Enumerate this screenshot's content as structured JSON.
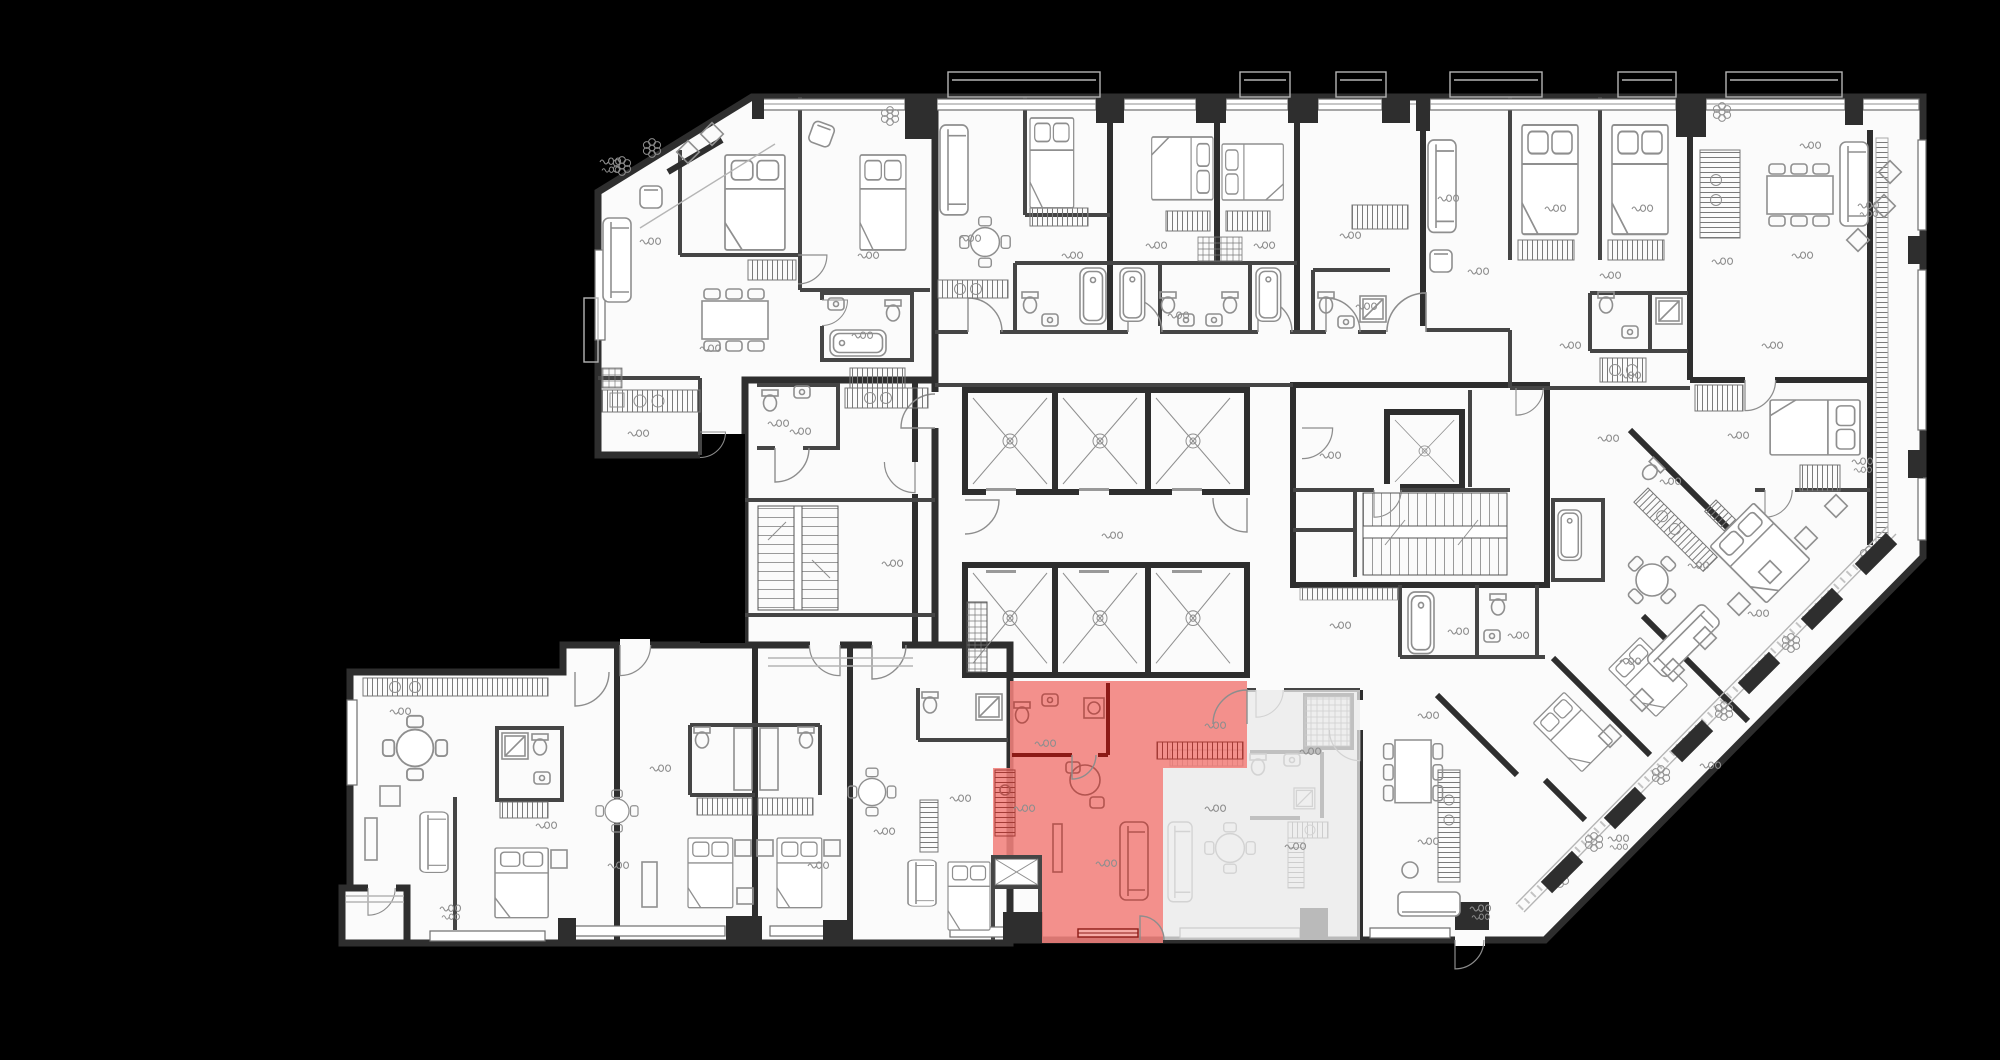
{
  "scene": {
    "background": "#000000",
    "floor": "#fbfbfb",
    "wall": "#2e2e2e",
    "partition": "#454545",
    "furniture": "#8f8f8f",
    "balcony_line": "#b5b5b5",
    "label_color": "#8e8e8e"
  },
  "selected_unit": {
    "name": "highlighted-apartment",
    "fill": "#f1817c",
    "border": "#9b1210",
    "inner_wall": "#8c1a16",
    "detail": "#b2544f",
    "window_fill": "#f6aaa5"
  },
  "secondary_unit": {
    "name": "adjacent-apartment-muted",
    "fill": "#e9e9e9"
  },
  "decor": {
    "room_labels": [
      [
        640,
        238
      ],
      [
        700,
        345
      ],
      [
        628,
        430
      ],
      [
        768,
        420
      ],
      [
        858,
        252
      ],
      [
        852,
        332
      ],
      [
        600,
        158,
        2
      ],
      [
        960,
        235
      ],
      [
        1062,
        252
      ],
      [
        1146,
        242
      ],
      [
        1254,
        242
      ],
      [
        1168,
        312
      ],
      [
        1340,
        232
      ],
      [
        1356,
        303
      ],
      [
        1438,
        195
      ],
      [
        1545,
        205
      ],
      [
        1632,
        205
      ],
      [
        1468,
        268
      ],
      [
        1600,
        272
      ],
      [
        1712,
        258
      ],
      [
        1800,
        142
      ],
      [
        1792,
        252
      ],
      [
        1858,
        202,
        2
      ],
      [
        1762,
        342
      ],
      [
        1560,
        342
      ],
      [
        1620,
        372
      ],
      [
        1598,
        435
      ],
      [
        1728,
        432
      ],
      [
        1660,
        478
      ],
      [
        1852,
        458,
        2
      ],
      [
        1688,
        562
      ],
      [
        1748,
        610
      ],
      [
        1620,
        658
      ],
      [
        1700,
        762
      ],
      [
        1608,
        835,
        2
      ],
      [
        790,
        428
      ],
      [
        882,
        560
      ],
      [
        1102,
        532
      ],
      [
        1320,
        452
      ],
      [
        1330,
        622
      ],
      [
        1448,
        628
      ],
      [
        1508,
        632
      ],
      [
        390,
        708
      ],
      [
        536,
        822
      ],
      [
        650,
        765
      ],
      [
        608,
        862
      ],
      [
        808,
        862
      ],
      [
        874,
        828
      ],
      [
        950,
        795
      ],
      [
        440,
        905,
        2
      ],
      [
        1300,
        748
      ],
      [
        1205,
        805
      ],
      [
        1285,
        843
      ],
      [
        1418,
        712
      ],
      [
        1418,
        838
      ],
      [
        1470,
        905,
        2
      ]
    ],
    "selected_labels": [
      [
        1035,
        740
      ],
      [
        1014,
        805
      ],
      [
        1096,
        860
      ],
      [
        1205,
        722
      ]
    ],
    "flowers": [
      [
        622,
        166
      ],
      [
        652,
        148
      ],
      [
        890,
        116
      ],
      [
        1722,
        112
      ],
      [
        1594,
        842
      ],
      [
        1661,
        775
      ],
      [
        1724,
        711
      ],
      [
        1791,
        643
      ],
      [
        1560,
        878
      ],
      [
        1869,
        556
      ]
    ],
    "top_balconies": [
      [
        948,
        152
      ],
      [
        1240,
        50
      ],
      [
        1336,
        50
      ],
      [
        1450,
        92
      ],
      [
        1618,
        58
      ],
      [
        1726,
        116
      ]
    ],
    "diag_piers": [
      [
        1562,
        872
      ],
      [
        1625,
        808
      ],
      [
        1692,
        741
      ],
      [
        1759,
        673
      ],
      [
        1822,
        609
      ],
      [
        1876,
        554
      ]
    ],
    "squares45": [
      [
        1642,
        700
      ],
      [
        1610,
        736
      ],
      [
        1705,
        638
      ],
      [
        1673,
        670
      ],
      [
        1770,
        572
      ],
      [
        1739,
        604
      ],
      [
        1836,
        506
      ],
      [
        1806,
        538
      ],
      [
        688,
        152
      ],
      [
        712,
        134
      ],
      [
        1884,
        206
      ],
      [
        1890,
        172
      ],
      [
        1858,
        240
      ]
    ]
  }
}
